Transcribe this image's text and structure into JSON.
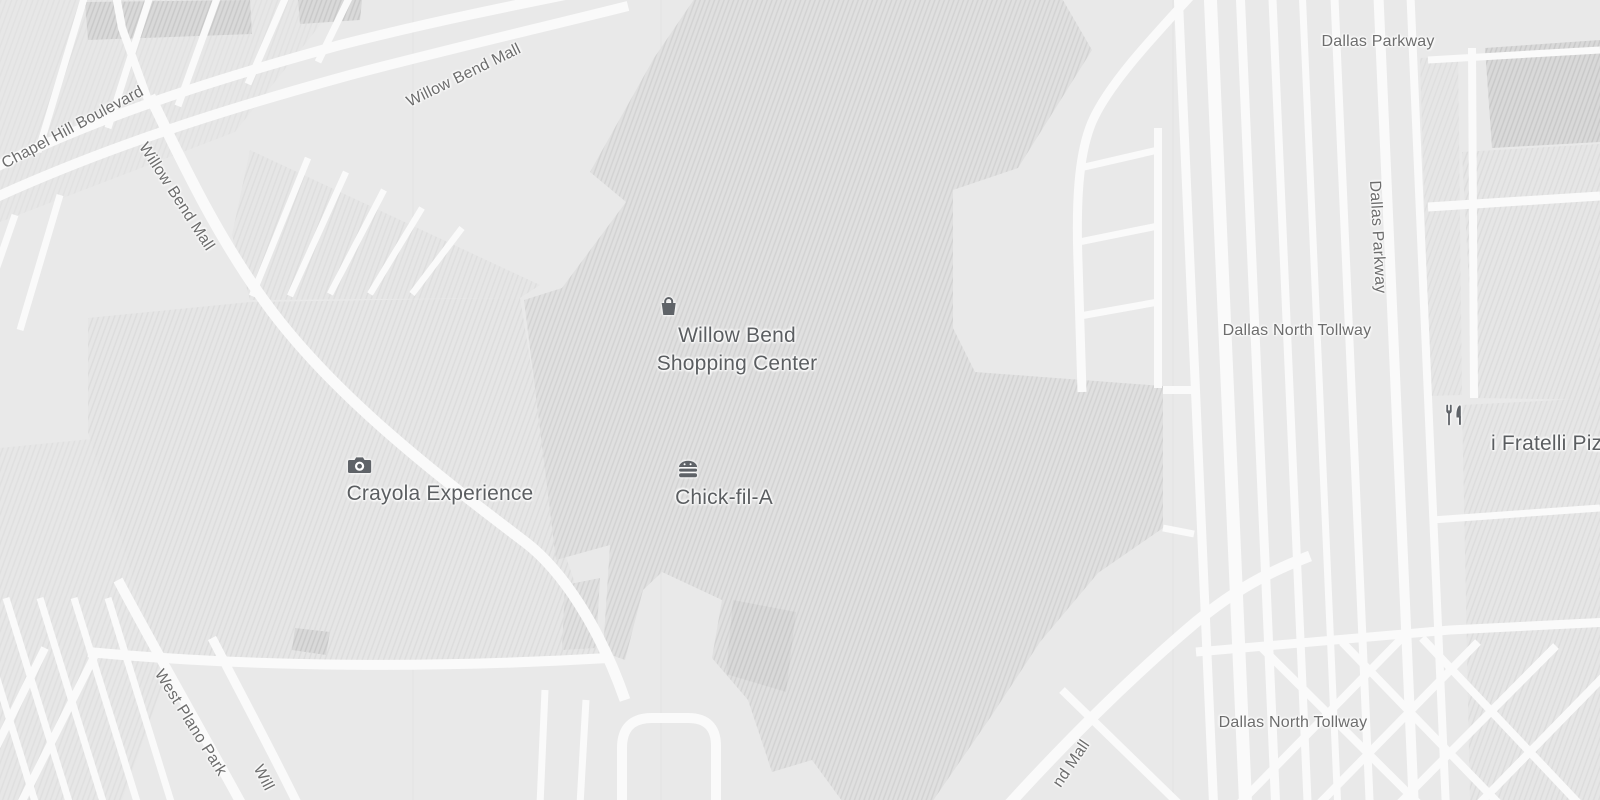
{
  "map": {
    "style": "grayscale-roadmap",
    "colors": {
      "background": "#e9e9e9",
      "road": "#fafafa",
      "building_fill": "#e0e0e0",
      "building_hatch": "#d2d2d2",
      "parking_hatch": "#dcdcdc",
      "road_label_text": "#6d6d6d",
      "poi_text": "#5b5e61",
      "poi_icon": "#5f6368"
    },
    "pois": {
      "shopping_center": {
        "line1": "Willow Bend",
        "line2": "Shopping Center",
        "icon": "shopping-bag-icon"
      },
      "crayola": {
        "label": "Crayola Experience",
        "icon": "camera-icon"
      },
      "chickfila": {
        "label": "Chick-fil-A",
        "icon": "burger-icon"
      },
      "ifratelli": {
        "label": "i Fratelli Pizz",
        "icon": "restaurant-icon"
      }
    },
    "road_labels": {
      "chapel_hill": "Chapel Hill Boulevard",
      "willow_bend_top": "Willow Bend Mall",
      "willow_bend_left": "Willow Bend Mall",
      "dallas_parkway_top": "Dallas Parkway",
      "dallas_parkway_right": "Dallas Parkway",
      "dallas_north_tollway_mid": "Dallas North Tollway",
      "dallas_north_tollway_bottom": "Dallas North Tollway",
      "west_plano_parkway": "West Plano Park",
      "willow_bend_bottom_partial": "Will",
      "willow_bend_mall_partial": "nd Mall"
    }
  }
}
